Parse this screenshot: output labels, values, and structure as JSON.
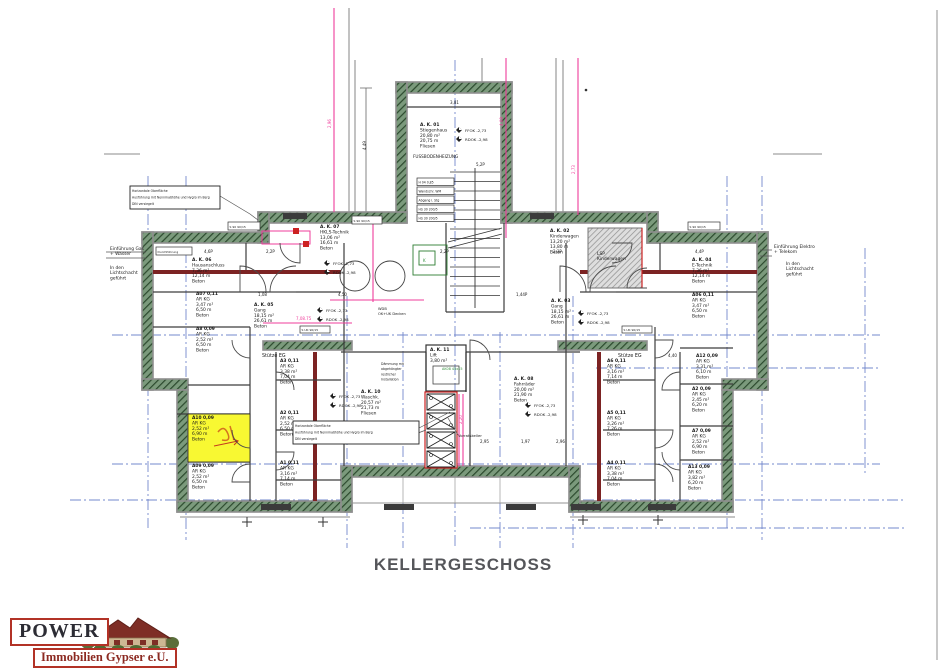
{
  "title": {
    "text": "KELLERGESCHOSS"
  },
  "logo": {
    "line1": "POWER",
    "line2": "Immobilien Gypser e.U."
  },
  "colors": {
    "grid": "#7388cc",
    "pink": "#ef3d9b",
    "wall_base": "#7b9a7c",
    "wall_hatch": "#2c4a2e",
    "maroon": "#7c2323",
    "ink": "#1a1a1a",
    "yellow": "#f8f832",
    "red": "#cc2222",
    "green_note": "#2f8f3a",
    "title": "#55565a",
    "logo_red": "#b23226"
  },
  "grid": {
    "vertical": [
      {
        "x": 148,
        "y1": 176,
        "y2": 528
      },
      {
        "x": 186,
        "y1": 176,
        "y2": 540
      },
      {
        "x": 347,
        "y1": 296,
        "y2": 548
      },
      {
        "x": 403,
        "y1": 332,
        "y2": 548
      },
      {
        "x": 455,
        "y1": 60,
        "y2": 548
      },
      {
        "x": 500,
        "y1": 332,
        "y2": 548
      },
      {
        "x": 573,
        "y1": 296,
        "y2": 548
      },
      {
        "x": 727,
        "y1": 176,
        "y2": 528
      },
      {
        "x": 762,
        "y1": 176,
        "y2": 540
      },
      {
        "x": 865,
        "y1": 248,
        "y2": 476
      }
    ],
    "horizontal": [
      {
        "y": 335,
        "x1": 112,
        "x2": 880
      },
      {
        "y": 368,
        "x1": 596,
        "x2": 880
      },
      {
        "y": 464,
        "x1": 112,
        "x2": 880
      },
      {
        "y": 500,
        "x1": 70,
        "x2": 905
      },
      {
        "y": 528,
        "x1": 470,
        "x2": 905
      }
    ]
  },
  "pink": {
    "vertical": [
      {
        "x": 334,
        "y1": 8,
        "y2": 212
      },
      {
        "x": 506,
        "y1": 58,
        "y2": 238
      },
      {
        "x": 578,
        "y1": 58,
        "y2": 215
      },
      {
        "x": 373,
        "y1": 222,
        "y2": 302
      },
      {
        "x": 459,
        "y1": 394,
        "y2": 466
      },
      {
        "x": 463,
        "y1": 394,
        "y2": 466
      }
    ],
    "horizontal": [
      {
        "y": 323,
        "x1": 263,
        "x2": 352
      },
      {
        "y": 300,
        "x1": 330,
        "x2": 424
      }
    ]
  },
  "rooms": [
    {
      "id": "stiegenhaus",
      "x": 420,
      "y": 126,
      "lines": [
        "A. K. 01",
        "Stiegenhaus",
        "20,80 m²",
        "20,75 m",
        "Fliesen"
      ]
    },
    {
      "id": "hkls-technik",
      "x": 320,
      "y": 228,
      "lines": [
        "A. K. 07",
        "HKLS-Technik",
        "13,06 m²",
        "16,61 m",
        "Beton"
      ]
    },
    {
      "id": "kinderwagen-raum",
      "x": 550,
      "y": 232,
      "lines": [
        "A. K. 02",
        "Kinderwagen",
        "13,20 m²",
        "13,80 m",
        "Beton"
      ]
    },
    {
      "id": "hausanschluss",
      "x": 192,
      "y": 261,
      "lines": [
        "A. K. 06",
        "Hausanschluss",
        "7,36 m²",
        "12,14 m",
        "Beton"
      ]
    },
    {
      "id": "e-technik",
      "x": 692,
      "y": 261,
      "lines": [
        "A. K. 04",
        "E-Technik",
        "7,36 m²",
        "12,14 m",
        "Beton"
      ]
    },
    {
      "id": "gang-links",
      "x": 254,
      "y": 306,
      "lines": [
        "A. K. 05",
        "Gang",
        "18,15 m²",
        "26,61 m",
        "Beton"
      ]
    },
    {
      "id": "gang-rechts",
      "x": 551,
      "y": 302,
      "lines": [
        "A. K. 03",
        "Gang",
        "18,15 m²",
        "26,61 m",
        "Beton"
      ]
    },
    {
      "id": "waschkueche",
      "x": 361,
      "y": 393,
      "lines": [
        "A. K. 10",
        "Waschk.",
        "20,57 m²",
        "21,73 m",
        "Fliesen"
      ]
    },
    {
      "id": "lift",
      "x": 430,
      "y": 351,
      "lines": [
        "A. K. 11",
        "Lift",
        "3,80 m²"
      ]
    },
    {
      "id": "fahrraeder",
      "x": 514,
      "y": 380,
      "lines": [
        "A. K. 08",
        "Fahrräder",
        "20,00 m²",
        "21,90 m",
        "Beton"
      ]
    },
    {
      "id": "ar-a07-links",
      "x": 196,
      "y": 295,
      "lines": [
        "A07 0,11",
        "AR KG",
        "3,47 m²",
        "6,50 m",
        "Beton"
      ]
    },
    {
      "id": "ar-a8-links",
      "x": 196,
      "y": 330,
      "lines": [
        "A8 0,09",
        "AR KG",
        "2,52 m²",
        "6,50 m",
        "Beton"
      ]
    },
    {
      "id": "ar-a10-gelb",
      "x": 192,
      "y": 419,
      "lines": [
        "A10 0,09",
        "AR KG",
        "2,52 m²",
        "6,90 m",
        "Beton"
      ]
    },
    {
      "id": "ar-a09-links",
      "x": 192,
      "y": 467,
      "lines": [
        "A09 0,09",
        "AR KG",
        "2,52 m²",
        "6,50 m",
        "Beton"
      ]
    },
    {
      "id": "ar-a3-mitte",
      "x": 280,
      "y": 362,
      "lines": [
        "A3 0,11",
        "AR KG",
        "3,38 m²",
        "7,04 m",
        "Beton"
      ]
    },
    {
      "id": "ar-a2-mitte",
      "x": 280,
      "y": 414,
      "lines": [
        "A2 0,11",
        "AR KG",
        "2,52 m²",
        "6,50 m",
        "Beton"
      ]
    },
    {
      "id": "ar-a1-mitte",
      "x": 280,
      "y": 464,
      "lines": [
        "A1 0,11",
        "AR KG",
        "3,16 m²",
        "7,14 m",
        "Beton"
      ]
    },
    {
      "id": "ar-a6-mitte-r",
      "x": 607,
      "y": 362,
      "lines": [
        "A6 0,11",
        "AR KG",
        "3,16 m²",
        "7,14 m",
        "Beton"
      ]
    },
    {
      "id": "ar-a5-mitte-r",
      "x": 607,
      "y": 414,
      "lines": [
        "A5 0,11",
        "AR KG",
        "3,26 m²",
        "7,26 m",
        "Beton"
      ]
    },
    {
      "id": "ar-a4-mitte-r",
      "x": 607,
      "y": 464,
      "lines": [
        "A4 0,11",
        "AR KG",
        "3,38 m²",
        "7,04 m",
        "Beton"
      ]
    },
    {
      "id": "ar-a06-rechts",
      "x": 692,
      "y": 296,
      "lines": [
        "A06 0,11",
        "AR KG",
        "3,47 m²",
        "6,50 m",
        "Beton"
      ]
    },
    {
      "id": "ar-a12-rechts",
      "x": 696,
      "y": 357,
      "lines": [
        "A12 0,09",
        "AR KG",
        "3,31 m²",
        "6,10 m",
        "Beton"
      ]
    },
    {
      "id": "ar-a02-rechts",
      "x": 692,
      "y": 390,
      "lines": [
        "A2 0,09",
        "AR KG",
        "2,45 m²",
        "6,20 m",
        "Beton"
      ]
    },
    {
      "id": "ar-a07-rechts",
      "x": 692,
      "y": 432,
      "lines": [
        "A7 0,09",
        "AR KG",
        "2,52 m²",
        "6,90 m",
        "Beton"
      ]
    },
    {
      "id": "ar-a13-rechts",
      "x": 688,
      "y": 468,
      "lines": [
        "A13 0,09",
        "AR KG",
        "3,82 m²",
        "6,20 m",
        "Beton"
      ]
    }
  ],
  "annotations": [
    {
      "id": "fussbodenheizung",
      "x": 413,
      "y": 158,
      "lines": [
        "FUSSBODENHEIZUNG"
      ],
      "fs": 4.2
    },
    {
      "id": "einfuehrung-gas",
      "x": 110,
      "y": 250,
      "lines": [
        "Einführung Gas",
        "+ Wasser"
      ],
      "fs": 4.4
    },
    {
      "id": "lichtschacht-links",
      "x": 110,
      "y": 269,
      "lines": [
        "In den",
        "Lichtschacht",
        "geführt"
      ],
      "fs": 4.4
    },
    {
      "id": "einfuehrung-elektro",
      "x": 774,
      "y": 248,
      "lines": [
        "Einführung Elektro",
        "+ Telekom"
      ],
      "fs": 4.4
    },
    {
      "id": "lichtschacht-rechts",
      "x": 786,
      "y": 265,
      "lines": [
        "In den",
        "Lichtschacht",
        "geführt"
      ],
      "fs": 4.4
    },
    {
      "id": "stuetze-eg-links",
      "x": 262,
      "y": 357,
      "lines": [
        "Stütze EG"
      ],
      "fs": 4.8
    },
    {
      "id": "stuetze-eg-rechts",
      "x": 618,
      "y": 357,
      "lines": [
        "Stütze EG"
      ],
      "fs": 4.8
    },
    {
      "id": "lsp-kinderwagen",
      "x": 597,
      "y": 255,
      "lines": [
        "LSP",
        "Kinderwagen"
      ],
      "fs": 4.4
    },
    {
      "id": "verfliesung-wand",
      "x": 366,
      "y": 441,
      "lines": [
        "Verfliesung Wand"
      ],
      "fs": 3.8
    },
    {
      "id": "vorratskeller",
      "x": 458,
      "y": 437,
      "lines": [
        "Vorratskeller"
      ],
      "fs": 3.8
    },
    {
      "id": "wdb-decken",
      "x": 378,
      "y": 310,
      "lines": [
        "WDB",
        "OK+UK Decken"
      ],
      "fs": 3.6
    },
    {
      "id": "daemmung-note",
      "x": 381,
      "y": 365,
      "lines": [
        "Dämmung mit",
        "abgehängter",
        "restlicher",
        "Installation"
      ],
      "fs": 3.2
    },
    {
      "id": "ak-tag",
      "x": 442,
      "y": 370,
      "lines": [
        "AK08 45x15"
      ],
      "fs": 3.4,
      "color": "green"
    },
    {
      "id": "k-box-label",
      "x": 423,
      "y": 262,
      "lines": [
        "K"
      ],
      "fs": 4,
      "color": "green"
    }
  ],
  "note_boxes": [
    {
      "x": 130,
      "y": 186,
      "w": 90,
      "h": 23,
      "lines": [
        "Horizontale Oberfläche",
        "Ausführung mit Nennmaßhöhe und Hygro im Berg",
        "DIN versiegelt"
      ]
    },
    {
      "x": 293,
      "y": 421,
      "w": 126,
      "h": 23,
      "lines": [
        "Horizontale Oberfläche",
        "Ausführung mit Nennmaßhöhe und Hygro im Berg",
        "DIN versiegelt"
      ]
    }
  ],
  "tags": [
    {
      "x": 228,
      "y": 222,
      "w": 32,
      "h": 8,
      "t": "S 90 90/15"
    },
    {
      "x": 688,
      "y": 222,
      "w": 32,
      "h": 8,
      "t": "S 90 90/15"
    },
    {
      "x": 156,
      "y": 247,
      "w": 36,
      "h": 8,
      "t": "Durchführung"
    },
    {
      "x": 352,
      "y": 216,
      "w": 30,
      "h": 8,
      "t": "S 90 90/15"
    },
    {
      "x": 300,
      "y": 326,
      "w": 30,
      "h": 7,
      "t": "S UK 90/15"
    },
    {
      "x": 622,
      "y": 326,
      "w": 30,
      "h": 7,
      "t": "S UK 90/15"
    }
  ],
  "hs_panel": {
    "x": 417,
    "y": 178,
    "w": 37,
    "rh": 9,
    "rows": [
      "H 04 0,85",
      "Wandschr. WM",
      "Abgang i. Stg",
      "HS 30 200/5",
      "HS 30 200/5"
    ]
  },
  "dimensions": [
    {
      "x": 204,
      "y": 253,
      "t": "4,6P"
    },
    {
      "x": 266,
      "y": 253,
      "t": "2,2P"
    },
    {
      "x": 440,
      "y": 253,
      "t": "2,2P"
    },
    {
      "x": 553,
      "y": 253,
      "t": "2,3P"
    },
    {
      "x": 695,
      "y": 253,
      "t": "4,4P"
    },
    {
      "x": 450,
      "y": 104,
      "t": "3,81"
    },
    {
      "x": 476,
      "y": 166,
      "t": "5,2P"
    },
    {
      "x": 338,
      "y": 296,
      "t": "4,50"
    },
    {
      "x": 258,
      "y": 296,
      "t": "1,08"
    },
    {
      "x": 516,
      "y": 296,
      "t": "1,44P"
    },
    {
      "x": 668,
      "y": 357,
      "t": "4,40"
    },
    {
      "x": 480,
      "y": 443,
      "t": "2,95"
    },
    {
      "x": 521,
      "y": 443,
      "t": "1,97"
    },
    {
      "x": 556,
      "y": 443,
      "t": "2,96"
    },
    {
      "x": 366,
      "y": 150,
      "t": "4,49",
      "rot": true
    },
    {
      "x": 331,
      "y": 128,
      "t": "2,96",
      "rot": true,
      "pink": true
    },
    {
      "x": 503,
      "y": 126,
      "t": "4,09",
      "rot": true,
      "pink": true
    },
    {
      "x": 575,
      "y": 174,
      "t": "2,73",
      "rot": true,
      "pink": true
    },
    {
      "x": 462,
      "y": 424,
      "t": "2,20",
      "rot": true,
      "pink": true
    },
    {
      "x": 296,
      "y": 320,
      "t": "7,08.75",
      "pink": true
    }
  ],
  "elevation": {
    "labels": [
      "FFOK -2,73",
      "RDOK -2,98"
    ],
    "points": [
      {
        "x": 459,
        "y": 130
      },
      {
        "x": 327,
        "y": 263
      },
      {
        "x": 320,
        "y": 310
      },
      {
        "x": 333,
        "y": 396
      },
      {
        "x": 528,
        "y": 405
      },
      {
        "x": 581,
        "y": 313
      }
    ]
  },
  "doors": [
    {
      "x": 250,
      "y": 340,
      "r": 18,
      "a1": 90,
      "a2": 180
    },
    {
      "x": 250,
      "y": 430,
      "r": 18,
      "a1": 90,
      "a2": 180
    },
    {
      "x": 250,
      "y": 482,
      "r": 18,
      "a1": 180,
      "a2": 270
    },
    {
      "x": 276,
      "y": 390,
      "r": 18,
      "a1": 270,
      "a2": 360
    },
    {
      "x": 276,
      "y": 452,
      "r": 18,
      "a1": 0,
      "a2": 90
    },
    {
      "x": 655,
      "y": 340,
      "r": 18,
      "a1": 0,
      "a2": 90
    },
    {
      "x": 655,
      "y": 430,
      "r": 18,
      "a1": 0,
      "a2": 90
    },
    {
      "x": 655,
      "y": 482,
      "r": 18,
      "a1": 270,
      "a2": 360
    },
    {
      "x": 680,
      "y": 390,
      "r": 18,
      "a1": 180,
      "a2": 270
    },
    {
      "x": 680,
      "y": 452,
      "r": 18,
      "a1": 90,
      "a2": 180
    },
    {
      "x": 240,
      "y": 292,
      "r": 26,
      "a1": 270,
      "a2": 360
    },
    {
      "x": 296,
      "y": 292,
      "r": 26,
      "a1": 180,
      "a2": 270
    },
    {
      "x": 560,
      "y": 292,
      "r": 26,
      "a1": 270,
      "a2": 360
    },
    {
      "x": 616,
      "y": 292,
      "r": 26,
      "a1": 180,
      "a2": 270
    },
    {
      "x": 470,
      "y": 360,
      "r": 20,
      "a1": 270,
      "a2": 360
    },
    {
      "x": 647,
      "y": 288,
      "r": 20,
      "a1": 180,
      "a2": 270
    },
    {
      "x": 300,
      "y": 243,
      "r": 20,
      "a1": 90,
      "a2": 180
    },
    {
      "x": 612,
      "y": 243,
      "r": 20,
      "a1": 0,
      "a2": 90
    }
  ],
  "stairs": {
    "x1": 450,
    "x2": 500,
    "yTop": 172,
    "step": 9.5,
    "count": 14,
    "railX": 475,
    "yBot": 308
  },
  "shaft": {
    "x": 425,
    "y": 392,
    "w": 32,
    "h": 76,
    "cellX": 427,
    "cellW": 28,
    "cellH": 16,
    "gap": 3,
    "cells": 4,
    "cellY": 394
  },
  "windows": [
    [
      261,
      504,
      30,
      6
    ],
    [
      384,
      504,
      30,
      6
    ],
    [
      506,
      504,
      30,
      6
    ],
    [
      571,
      504,
      30,
      6
    ],
    [
      648,
      504,
      28,
      6
    ],
    [
      283,
      213,
      24,
      6
    ],
    [
      530,
      213,
      24,
      6
    ]
  ],
  "survey": [
    [
      247,
      522
    ],
    [
      323,
      522
    ],
    [
      583,
      520
    ],
    [
      658,
      520
    ]
  ]
}
